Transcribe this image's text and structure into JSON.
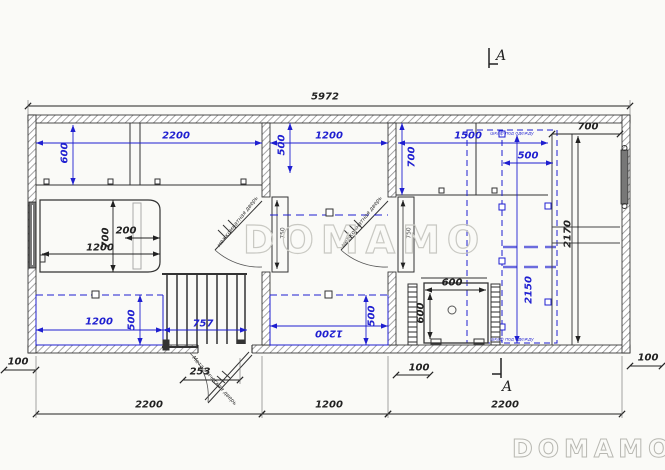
{
  "watermark": {
    "text_center": "DOMAMO",
    "text_corner": "DOMAMO"
  },
  "section_marker": {
    "top_label": "A",
    "bottom_label": "A"
  },
  "dims": {
    "overall": "5972",
    "room1_top": "2200",
    "room1_side": "600",
    "room2_top": "1200",
    "room2_side": "500",
    "room3_top": "1500",
    "room3_side": "700",
    "wardrobe_top": "500",
    "wardrobe_height": "2150",
    "shelf_top": "700",
    "cabinet_height": "2170",
    "bed_length": "1200",
    "bed_width": "700",
    "bed_shelf": "200",
    "room1_bottom": "1200",
    "room1_bottom_side": "500",
    "radiator": "757",
    "room2_bottom": "1200",
    "room2_bottom_side": "500",
    "shower_width": "600",
    "shower_depth": "600",
    "door_left": "750",
    "door_right": "750",
    "entrance": "253",
    "offset_left": "100",
    "offset_mid": "100",
    "offset_right": "100",
    "bottom_room1": "2200",
    "bottom_room2": "1200",
    "bottom_room3": "2200"
  },
  "labels": {
    "interior_door_left": "межкомнатная дверь",
    "interior_door_right": "межкомнатная дверь",
    "entrance_door": "Металлическая дверь",
    "wardrobe_top_note": "шкаф под одежду",
    "wardrobe_bottom_note": "шкаф под одежду"
  },
  "colors": {
    "dimension_blue": "#1f1fd0",
    "line_black": "#222222",
    "watermark_gray": "#c9c9c3"
  }
}
